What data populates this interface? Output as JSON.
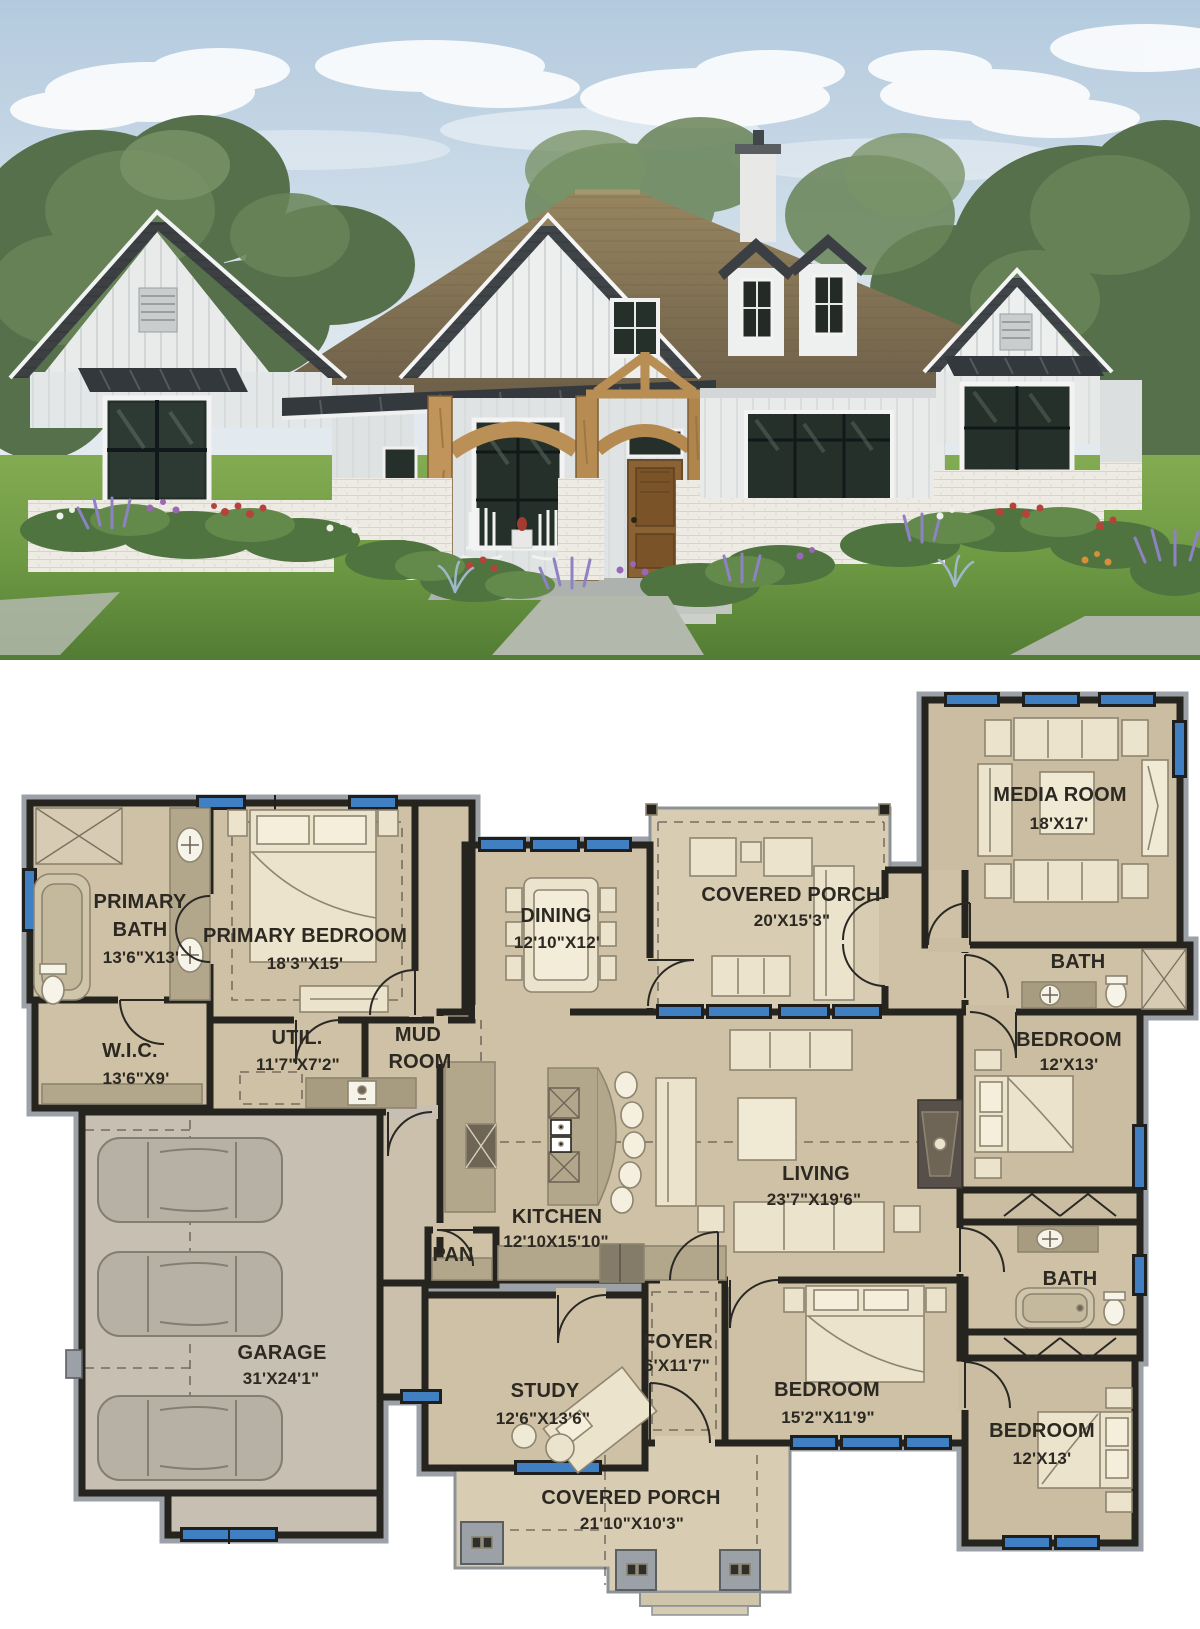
{
  "meta": {
    "title": "Modern farmhouse plan — exterior rendering and first-floor plan",
    "image_sections": [
      "exterior-photo",
      "floor-plan"
    ]
  },
  "photo": {
    "description": "Front elevation rendering of a white board-and-batten modern farmhouse with dark shingle gable roofs, brown main roof, cedar timber entry portico, white brick bases, flower beds and lawn",
    "colors": {
      "sky": "#bdd0e2",
      "cloud": "#f4f6f6",
      "tree": "#55704b",
      "lawn": "#6f9a44",
      "roof_brown": "#8a795d",
      "roof_dark": "#3f4347",
      "siding": "#eceeee",
      "timber": "#bb9056",
      "brick": "#edebe3",
      "door": "#8a6234",
      "glass": "#26302a"
    }
  },
  "plan": {
    "colors": {
      "wall": "#26241f",
      "casing": "#9ba1a6",
      "floor": "#cfc1a5",
      "porch_floor": "#d8ccb2",
      "garage_floor": "#c7bfb1",
      "window": "#4080c2",
      "furniture": "#ece3cc",
      "counter": "#b2a78b",
      "appliance": "#6e6557"
    },
    "rooms": [
      {
        "id": "primary-bath",
        "line1": "PRIMARY",
        "line2": "BATH",
        "dims": "13'6\"X13'"
      },
      {
        "id": "primary-bedroom",
        "line1": "PRIMARY BEDROOM",
        "dims": "18'3\"X15'"
      },
      {
        "id": "wic",
        "line1": "W.I.C.",
        "dims": "13'6\"X9'"
      },
      {
        "id": "util",
        "line1": "UTIL.",
        "dims": "11'7\"X7'2\""
      },
      {
        "id": "mud-room",
        "line1": "MUD",
        "line2": "ROOM"
      },
      {
        "id": "dining",
        "line1": "DINING",
        "dims": "12'10\"X12'"
      },
      {
        "id": "covered-porch-rear",
        "line1": "COVERED PORCH",
        "dims": "20'X15'3\""
      },
      {
        "id": "media-room",
        "line1": "MEDIA ROOM",
        "dims": "18'X17'"
      },
      {
        "id": "bath-upper",
        "line1": "BATH"
      },
      {
        "id": "bedroom-right",
        "line1": "BEDROOM",
        "dims": "12'X13'"
      },
      {
        "id": "living",
        "line1": "LIVING",
        "dims": "23'7\"X19'6\""
      },
      {
        "id": "kitchen",
        "line1": "KITCHEN",
        "dims": "12'10X15'10\""
      },
      {
        "id": "pantry",
        "line1": "PAN"
      },
      {
        "id": "garage",
        "line1": "GARAGE",
        "dims": "31'X24'1\""
      },
      {
        "id": "study",
        "line1": "STUDY",
        "dims": "12'6\"X13'6\""
      },
      {
        "id": "foyer",
        "line1": "FOYER",
        "dims": "6'X11'7\""
      },
      {
        "id": "bedroom-middle",
        "line1": "BEDROOM",
        "dims": "15'2\"X11'9\""
      },
      {
        "id": "bath-lower",
        "line1": "BATH"
      },
      {
        "id": "bedroom-lower",
        "line1": "BEDROOM",
        "dims": "12'X13'"
      },
      {
        "id": "covered-porch-front",
        "line1": "COVERED PORCH",
        "dims": "21'10\"X10'3\""
      }
    ]
  }
}
